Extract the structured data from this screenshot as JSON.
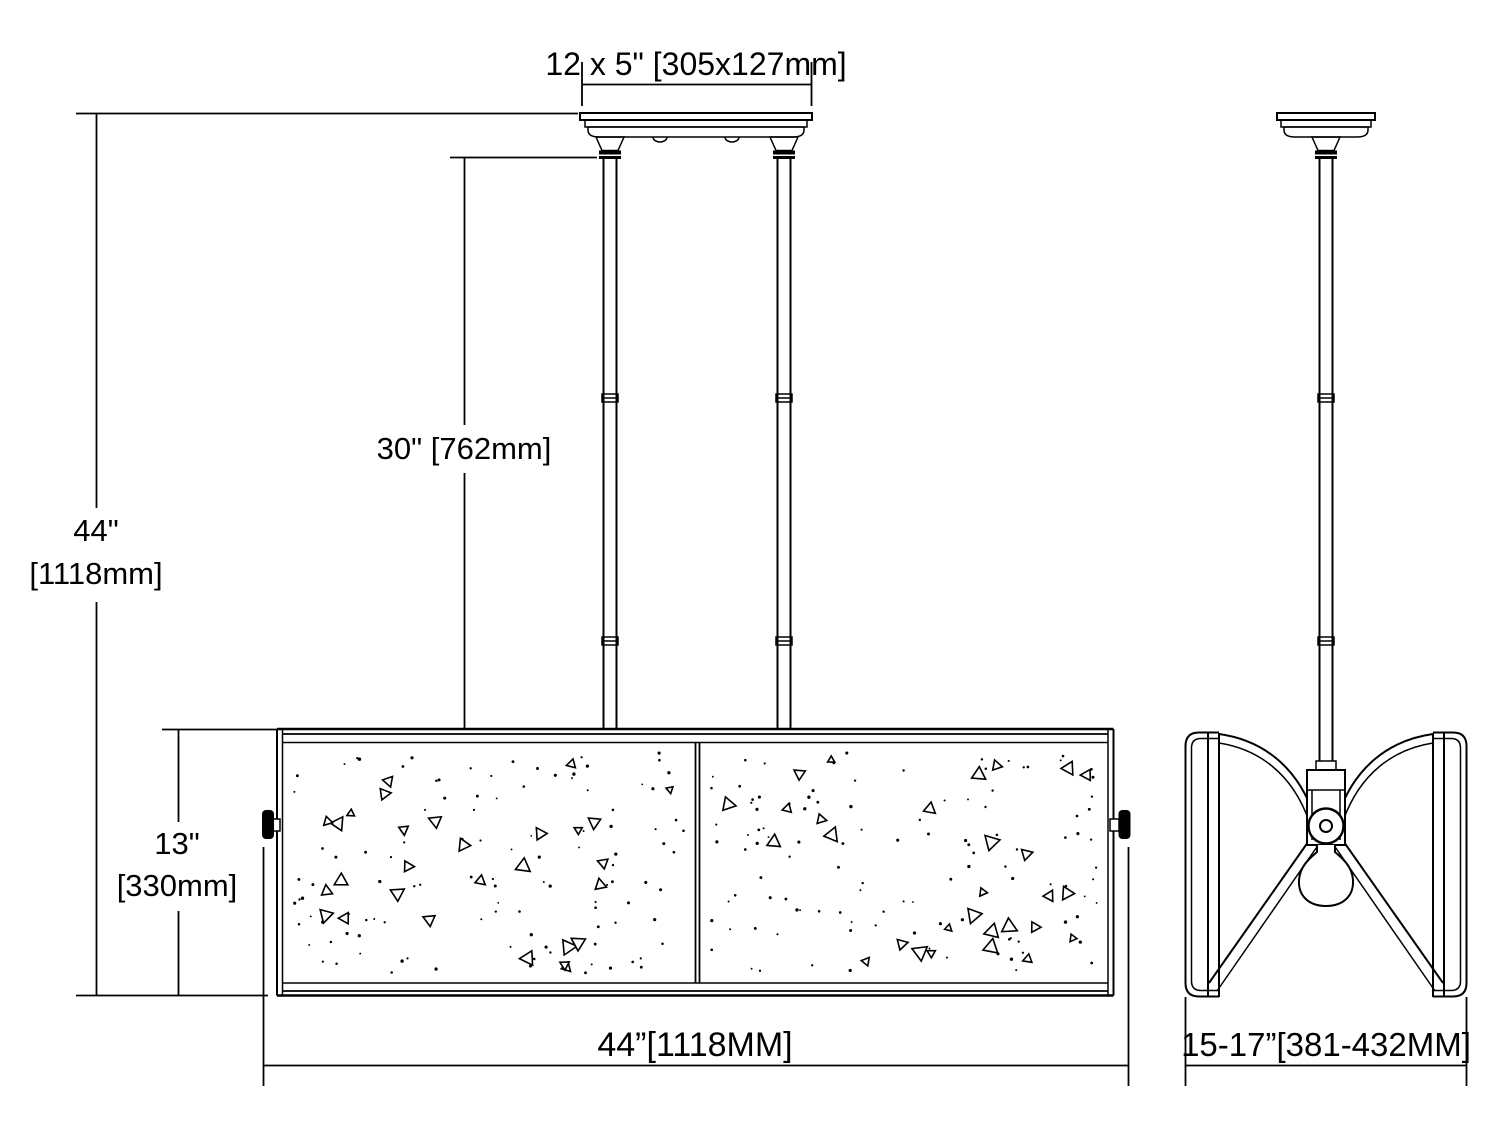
{
  "dimensions": {
    "canopy_size": "12 x 5\" [305x127mm]",
    "overall_height_in": "44\"",
    "overall_height_mm": "[1118mm]",
    "rod_length": "30\" [762mm]",
    "shade_height_in": "13\"",
    "shade_height_mm": "[330mm]",
    "shade_width": "44”[1118MM]",
    "side_width": "15-17”[381-432MM]"
  },
  "line_color": "#000000",
  "background_color": "#ffffff"
}
